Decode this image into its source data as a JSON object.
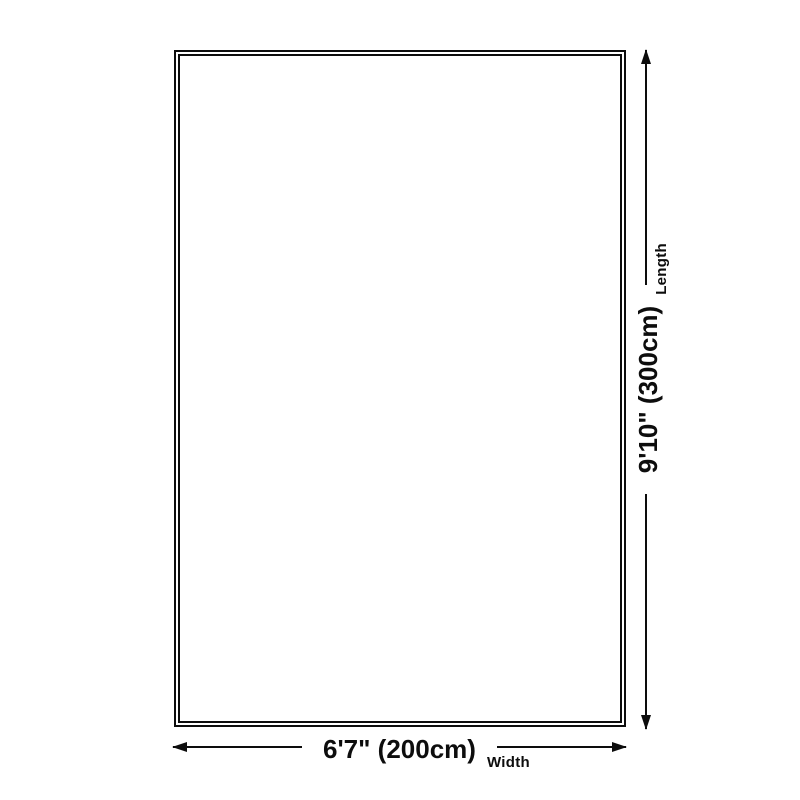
{
  "diagram": {
    "title": "rug-size-diagram",
    "rug": {
      "shape": "rectangle",
      "border_style": "double",
      "fill": "#ffffff"
    },
    "width": {
      "value": "6'7\" (200cm)",
      "label": "Width"
    },
    "length": {
      "value": "9'10\" (300cm)",
      "label": "Length"
    },
    "colors": {
      "line": "#0d0d0d",
      "background": "#ffffff"
    },
    "icons": {
      "left_arrow": "arrowhead-left",
      "right_arrow": "arrowhead-right",
      "up_arrow": "arrowhead-up",
      "down_arrow": "arrowhead-down"
    }
  }
}
